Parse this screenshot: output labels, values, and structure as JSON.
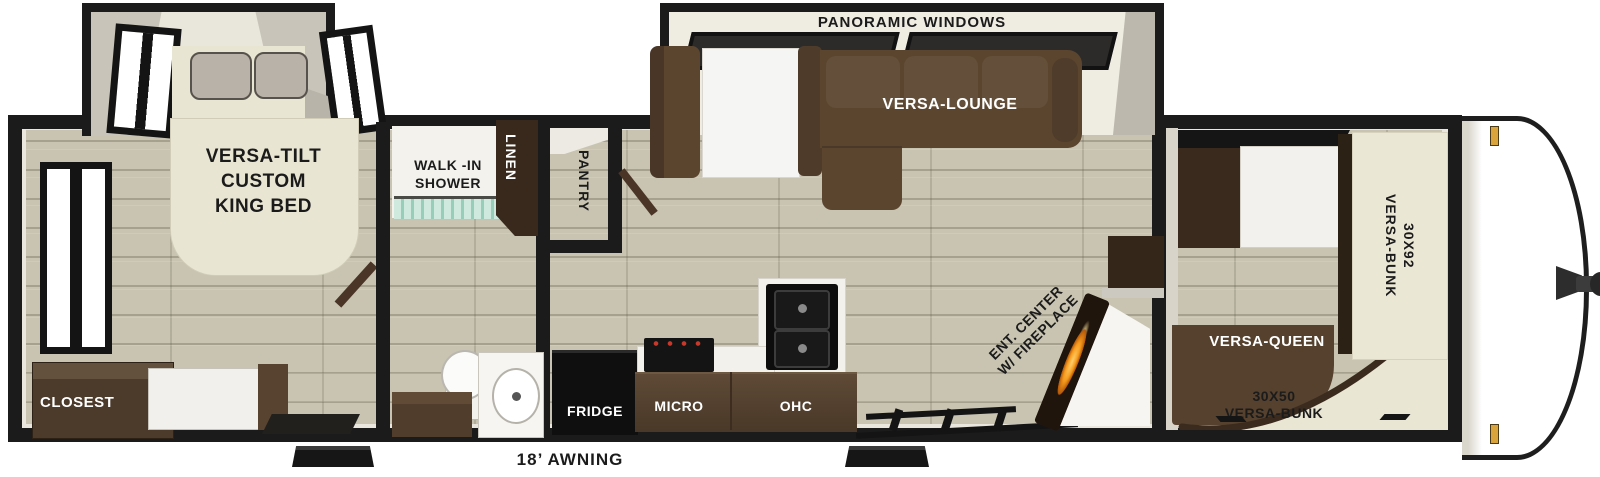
{
  "floorplan": {
    "exterior": {
      "panoramic_windows": "PANORAMIC WINDOWS",
      "awning": "18’ AWNING"
    },
    "bedroom": {
      "bed": "VERSA-TILT\nCUSTOM\nKING BED",
      "closet": "CLOSEST"
    },
    "bathroom": {
      "shower": "WALK -IN\nSHOWER",
      "linen": "LINEN"
    },
    "kitchen": {
      "pantry": "PANTRY",
      "fridge": "FRIDGE",
      "micro": "MICRO",
      "ohc": "OHC"
    },
    "living": {
      "lounge": "VERSA-LOUNGE",
      "ent_center": "ENT. CENTER\nW/ FIREPLACE"
    },
    "bunk_room": {
      "bunk_large": "30X92\nVERSA-BUNK",
      "queen": "VERSA-QUEEN",
      "bunk_small": "30X50\nVERSA-BUNK"
    },
    "colors": {
      "wall": "#1b1b1b",
      "floor": "#c8c4b1",
      "furniture_brown": "#55412d",
      "bed_cream": "#e8e5d2",
      "flame_accent": "#f59a1c",
      "marker_light": "#d9a43c"
    }
  }
}
